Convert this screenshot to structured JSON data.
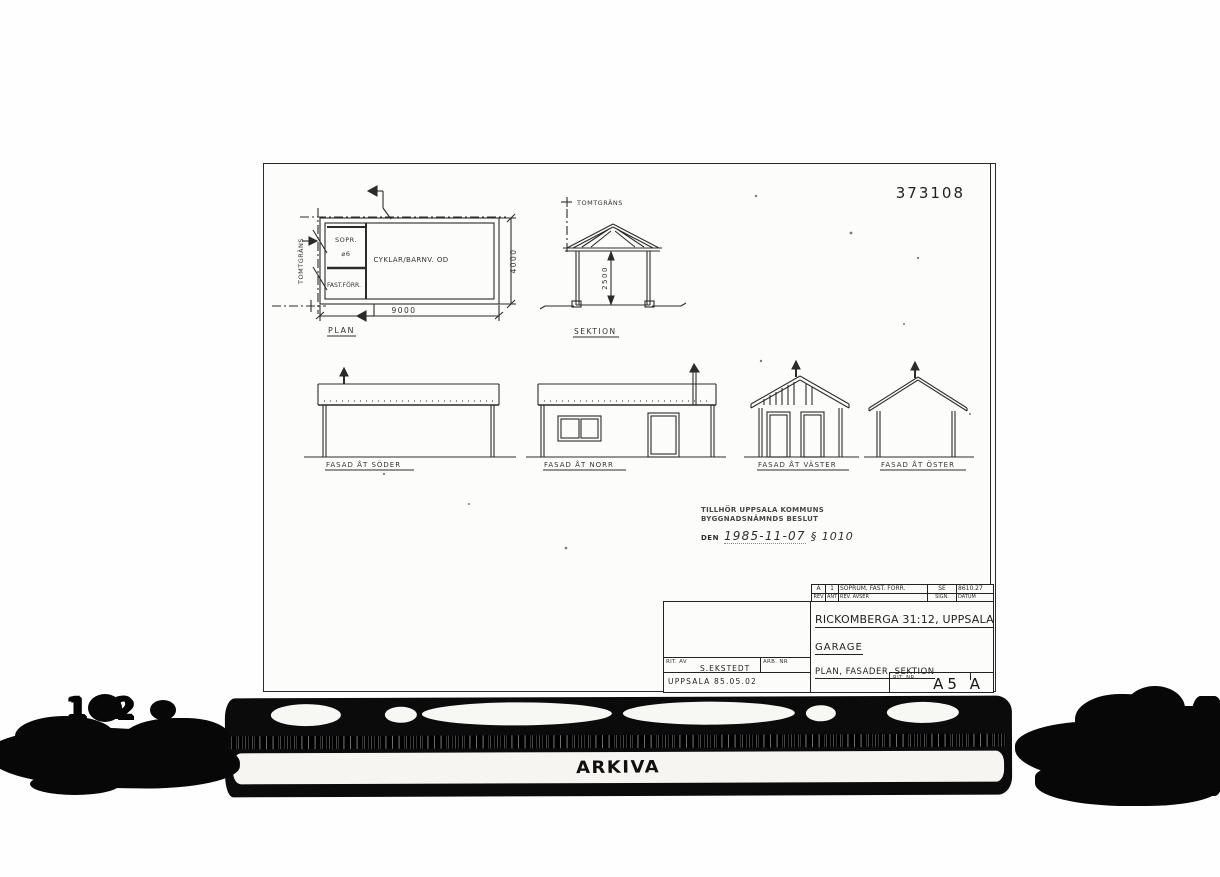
{
  "sheet": {
    "number": "373108",
    "plan": {
      "label": "PLAN",
      "boundary_label": "TOMTGRÄNS",
      "room_small_top_line1": "SOPR.",
      "room_small_top_line2": "⌀6",
      "room_small_bottom": "FAST.FÖRR.",
      "room_main": "CYKLAR/BARNV. OD",
      "dim_width": "9000",
      "dim_height": "4000"
    },
    "section": {
      "label": "SEKTION",
      "boundary_label": "TOMTGRÄNS",
      "dim_height": "2500"
    },
    "facades": [
      {
        "label": "FASAD ÅT SÖDER"
      },
      {
        "label": "FASAD ÅT NORR"
      },
      {
        "label": "FASAD ÅT VÄSTER"
      },
      {
        "label": "FASAD ÅT ÖSTER"
      }
    ],
    "stamp": {
      "line1": "TILLHÖR UPPSALA KOMMUNS",
      "line2": "BYGGNADSNÄMNDS BESLUT",
      "prefix": "DEN",
      "date": "1985-11-07",
      "paragraph": "§ 1010"
    },
    "titleblock": {
      "revision_row": {
        "rev": "A",
        "ant": "1",
        "avser": "SOPRUM, FAST. FÖRR.",
        "sign": "SE",
        "datum": "8610.27"
      },
      "revision_headers": {
        "rev": "REV",
        "ant": "ANT",
        "avser": "REV. AVSER",
        "sign": "SIGN.",
        "datum": "DATUM"
      },
      "title_line1": "RICKOMBERGA 31:12, UPPSALA",
      "title_line2": "GARAGE",
      "title_line3": "PLAN, FASADER, SEKTION",
      "drawn_by_label": "RIT. AV",
      "drawn_by": "S.EKSTEDT",
      "job_no_label": "ARB. NR",
      "place_date": "UPPSALA  85.05.02",
      "drawing_no_label": "RIT. NR.",
      "drawing_no": "A5 A"
    }
  },
  "scanner": {
    "left_number": "142",
    "brand": "ARKIVA"
  },
  "colors": {
    "ink": "#2b2b2b",
    "paper": "#fcfcfa",
    "scan_black": "#0b0b0b"
  }
}
